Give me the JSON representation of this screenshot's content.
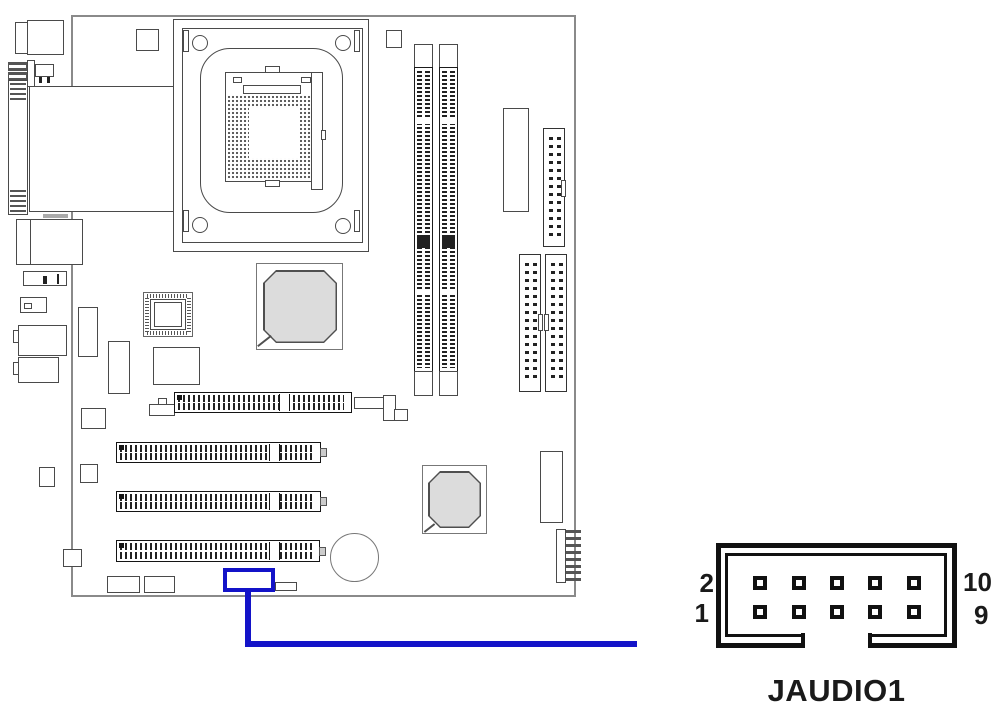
{
  "figure": {
    "caption": "JAUDIO1",
    "connector": {
      "name": "JAUDIO1",
      "rows": 2,
      "cols": 5,
      "total_pins": 10,
      "pin_labels": {
        "top_left": "2",
        "bottom_left": "1",
        "top_right": "10",
        "bottom_right": "9"
      }
    },
    "colors": {
      "highlight": "#1313c8",
      "chip_fill": "#dcdcdc",
      "line": "#1a1a1a"
    }
  }
}
